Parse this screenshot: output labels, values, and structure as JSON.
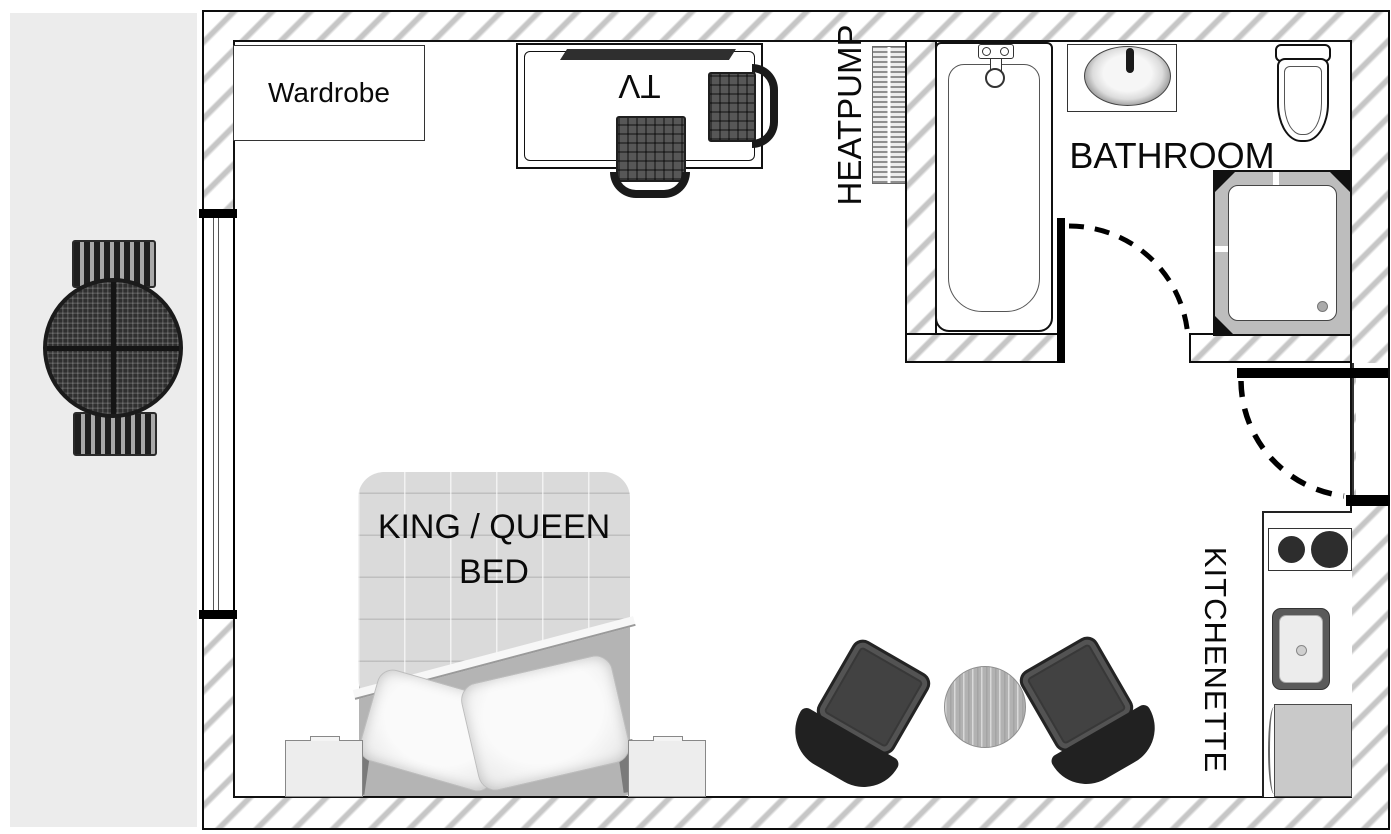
{
  "document": {
    "type": "floor-plan",
    "unit": "studio-motel-room"
  },
  "labels": {
    "wardrobe": "Wardrobe",
    "tv": "TV",
    "heatpump": "HEATPUMP",
    "bathroom": "BATHROOM",
    "bed_line1": "KING / QUEEN",
    "bed_line2": "BED",
    "kitchenette": "KITCHENETTE"
  },
  "colors": {
    "outdoor_area": "#ececec",
    "wall_hatch_stripe": "#c6c6c6",
    "wall_outline": "#0d0d0d",
    "dark_furniture": "#2f2f2f",
    "bed_duvet": "#dadada",
    "bed_sheet": "#b4b4b4",
    "appliance_gray": "#c9c9c9"
  },
  "fixtures": {
    "bathroom": [
      "bathtub",
      "vanity-sink",
      "toilet",
      "shower"
    ],
    "kitchenette": [
      "cooktop",
      "kitchen-sink",
      "fridge"
    ],
    "main_room": [
      "wardrobe",
      "tv-desk",
      "desk-chairs",
      "king-queen-bed",
      "nightstands",
      "lounge-chairs",
      "round-table",
      "heatpump"
    ],
    "outdoor": [
      "patio-table",
      "patio-benches"
    ]
  }
}
